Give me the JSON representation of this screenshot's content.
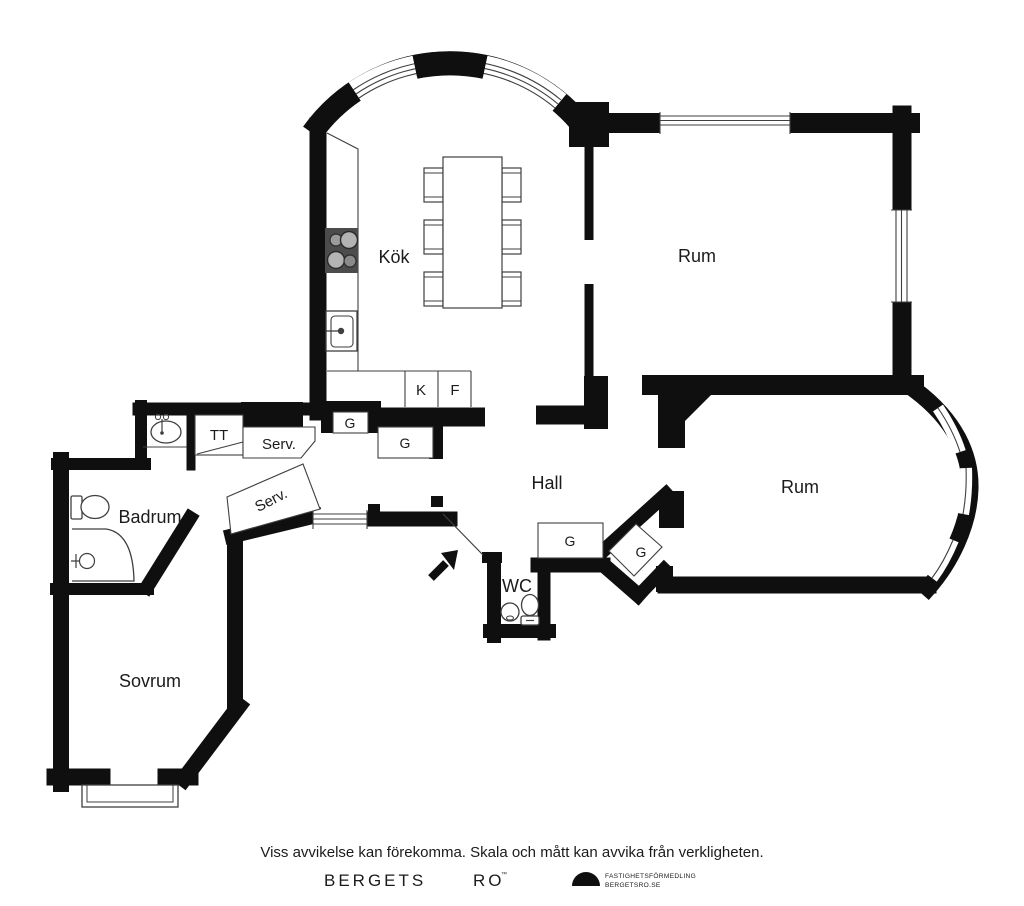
{
  "plan": {
    "rooms": {
      "kitchen": "Kök",
      "room_top": "Rum",
      "room_right": "Rum",
      "hall": "Hall",
      "wc": "WC",
      "bathroom": "Badrum",
      "bedroom": "Sovrum"
    },
    "closets": {
      "tt": "TT",
      "serv_top": "Serv.",
      "serv_diag": "Serv.",
      "g1": "G",
      "g2": "G",
      "g3": "G",
      "g4": "G",
      "fridge": "K",
      "freezer": "F"
    },
    "colors": {
      "wall": "#0f0f0f",
      "thin_line": "#3f3f3f",
      "stove": "#4c4c4c"
    }
  },
  "footer": {
    "disclaimer": "Viss avvikelse kan förekomma. Skala och mått kan avvika från verkligheten.",
    "brand_left": "BERGETS",
    "brand_right": "RO",
    "trademark": "™",
    "agency_line1": "FASTIGHETSFÖRMEDLING",
    "agency_line2": "BERGETSRO.SE"
  }
}
